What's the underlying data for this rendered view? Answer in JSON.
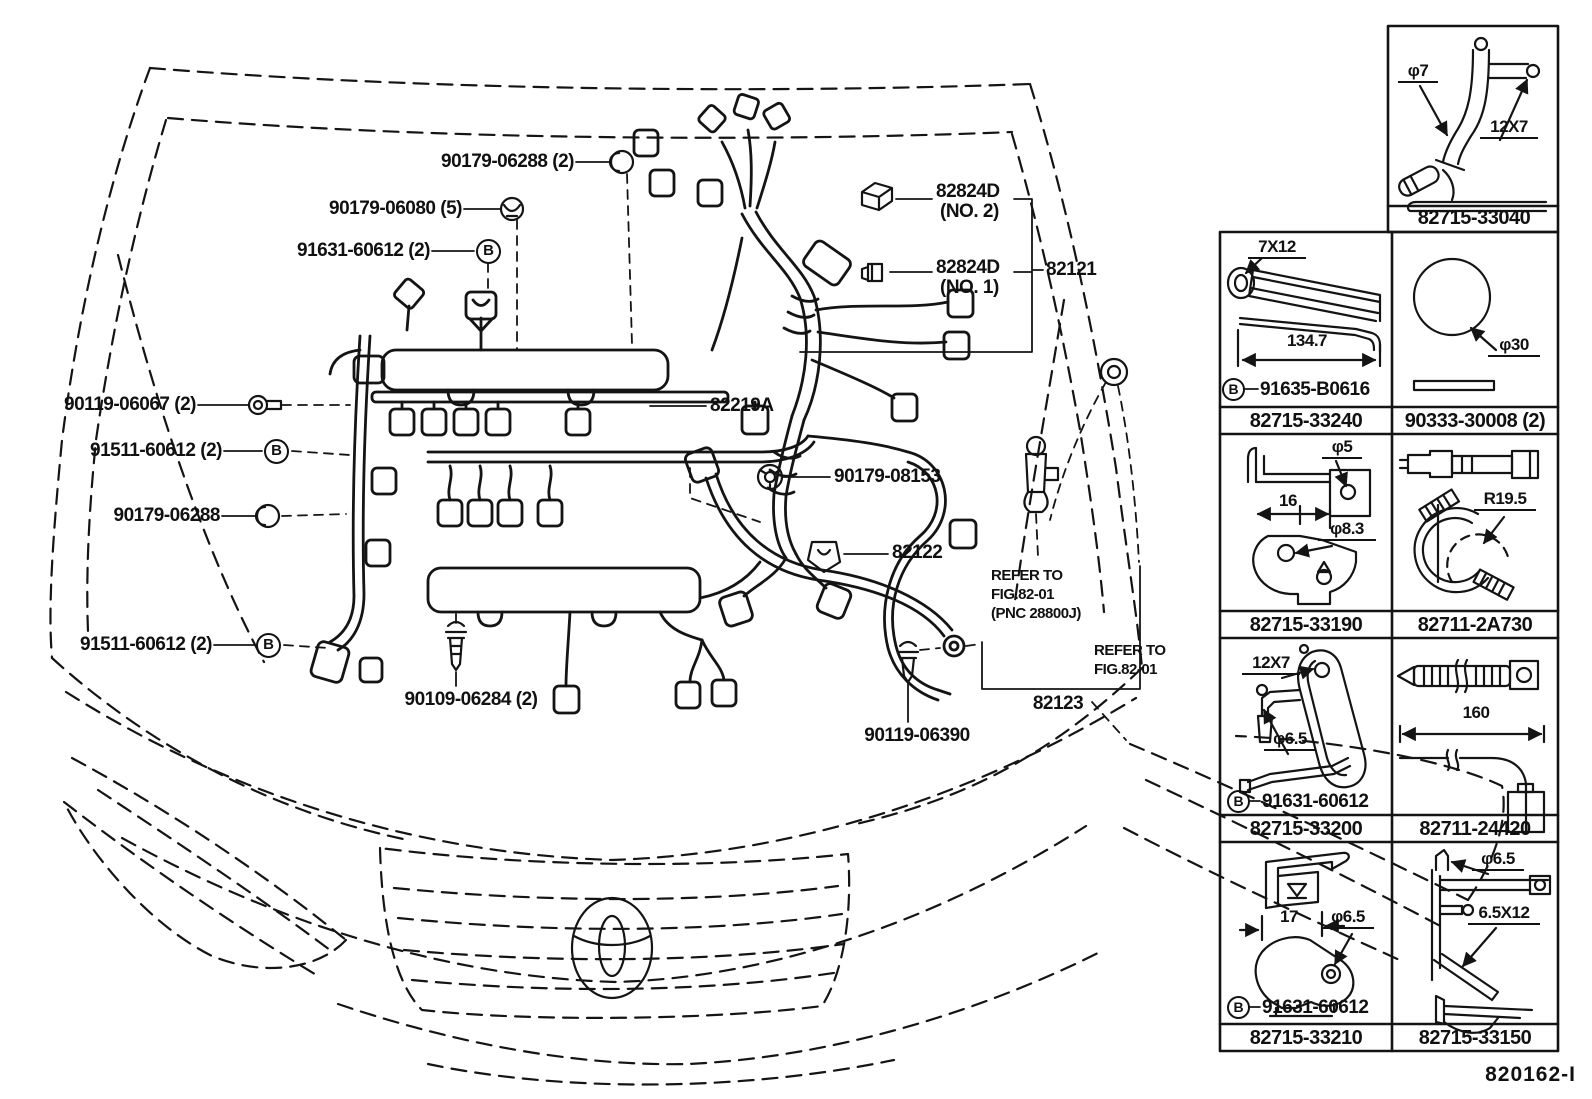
{
  "doc": {
    "figure_code": "820162-I",
    "b_symbol": "B"
  },
  "labels": {
    "bolt_06288_2": "90179-06288 (2)",
    "screw_06080": "90179-06080 (5)",
    "b_60612_top": "91631-60612 (2)",
    "bolt_06067": "90119-06067 (2)",
    "b_60612_mid": "91511-60612 (2)",
    "clip_06288": "90179-06288",
    "b_60612_low": "91511-60612 (2)",
    "screw_06284": "90109-06284 (2)",
    "screw_06390": "90119-06390",
    "nut_08153": "90179-08153",
    "p82122": "82122",
    "p82219a": "82219A",
    "p82824d_2": "82824D",
    "p82824d_2_no": "(NO. 2)",
    "p82824d_1": "82824D",
    "p82824d_1_no": "(NO. 1)",
    "p82121": "82121",
    "p82123": "82123"
  },
  "refer1": {
    "l1": "REFER TO",
    "l2": "FIG.82-01",
    "l3": "(PNC 28800J)"
  },
  "refer2": {
    "l1": "REFER TO",
    "l2": "FIG.82-01"
  },
  "panel": {
    "c040": {
      "num": "82715-33040",
      "a1": "φ7",
      "a2": "12X7"
    },
    "c240": {
      "num": "82715-33240",
      "a1": "7X12",
      "dim": "134.7",
      "b": "B",
      "bnum": "91635-B0616"
    },
    "c008": {
      "num": "90333-30008 (2)",
      "a1": "φ30"
    },
    "c190": {
      "num": "82715-33190",
      "a1": "φ5",
      "dim": "16",
      "a2": "φ8.3"
    },
    "c730": {
      "num": "82711-2A730",
      "a1": "R19.5"
    },
    "c200": {
      "num": "82715-33200",
      "a1": "12X7",
      "a2": "φ6.5",
      "b": "B",
      "bnum": "91631-60612"
    },
    "c420": {
      "num": "82711-24420",
      "dim": "160"
    },
    "c210": {
      "num": "82715-33210",
      "dim": "17",
      "a1": "φ6.5",
      "b": "B",
      "bnum": "91631-60612"
    },
    "c150": {
      "num": "82715-33150",
      "a1": "φ6.5",
      "a2": "6.5X12"
    }
  }
}
